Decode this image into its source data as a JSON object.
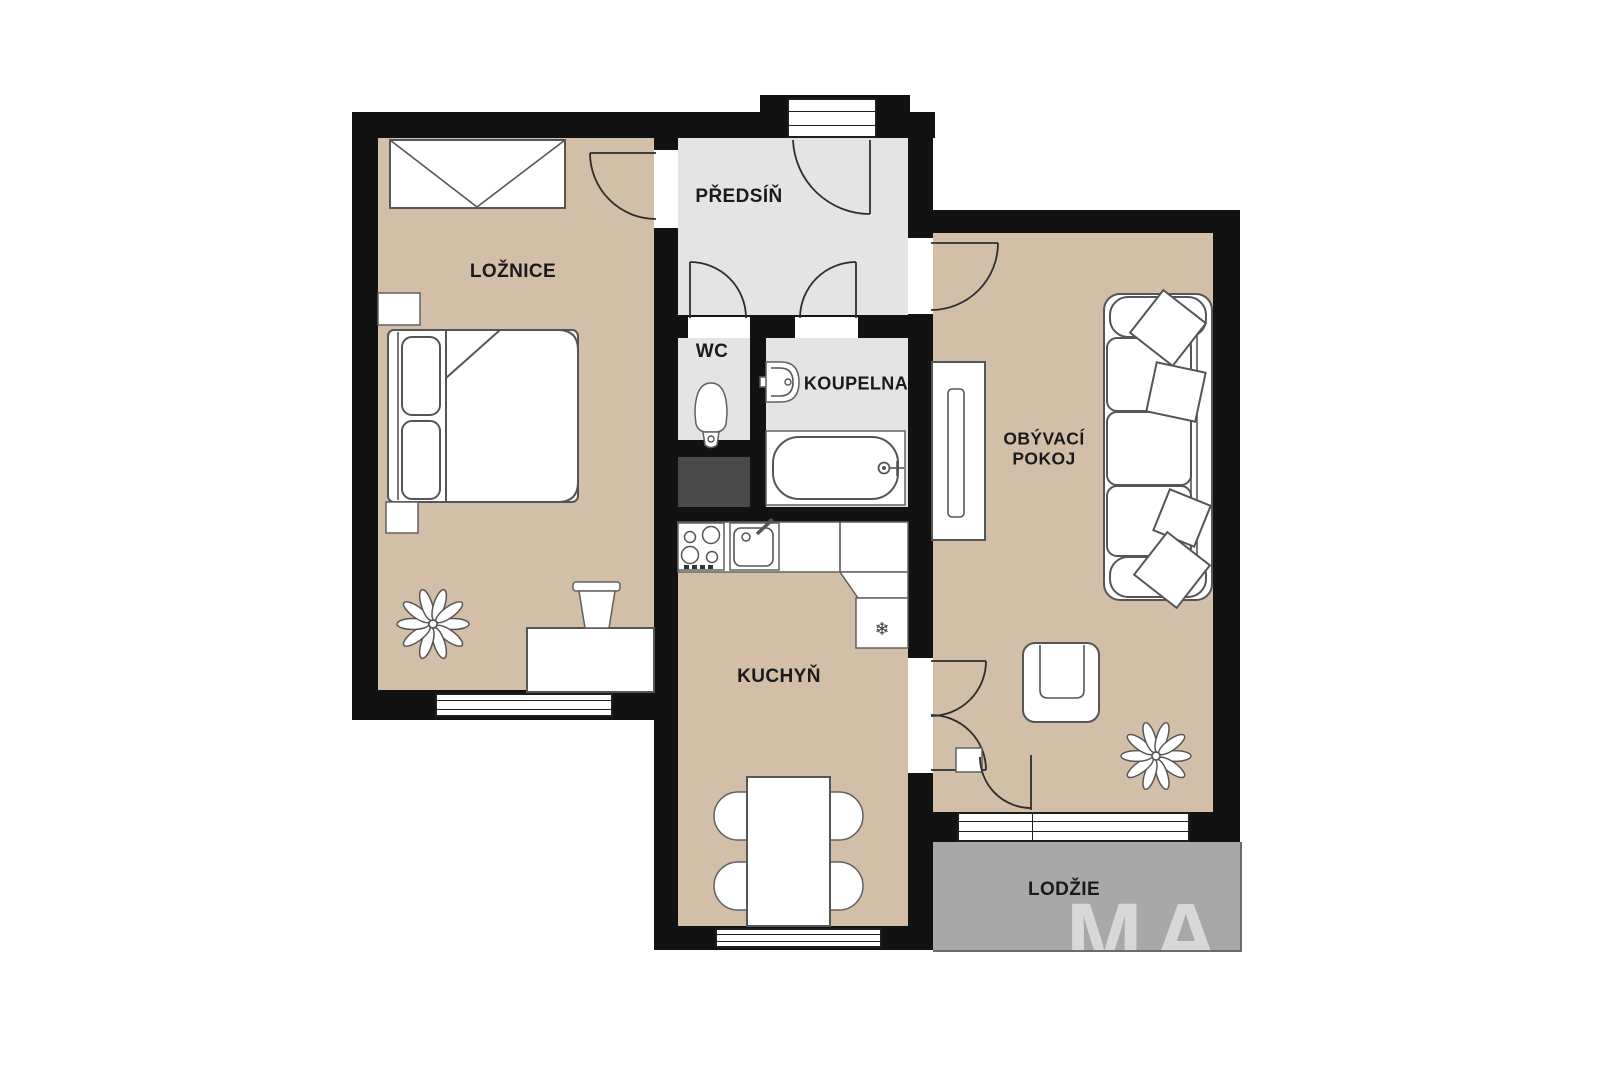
{
  "plan": {
    "rooms": {
      "loznice": {
        "label": "LOŽNICE"
      },
      "predsin": {
        "label": "PŘEDSÍŇ"
      },
      "wc": {
        "label": "WC"
      },
      "koupelna": {
        "label": "KOUPELNA"
      },
      "obyvaci_pokoj": {
        "label": "OBÝVACÍ POKOJ"
      },
      "kuchyn": {
        "label": "KUCHYŇ"
      },
      "lodzie": {
        "label": "LODŽIE"
      }
    },
    "watermark": "MA",
    "fixtures": {
      "fridge_icon": "❄"
    },
    "colors": {
      "wall": "#121212",
      "floor_room_beige": "#d3bea7",
      "floor_hall_gray": "#e4e4e4",
      "floor_loggia_gray": "#a8a8a8",
      "shaft_dark": "#4a4a4a",
      "furniture_fill": "#ffffff",
      "furniture_stroke": "#555555"
    }
  }
}
